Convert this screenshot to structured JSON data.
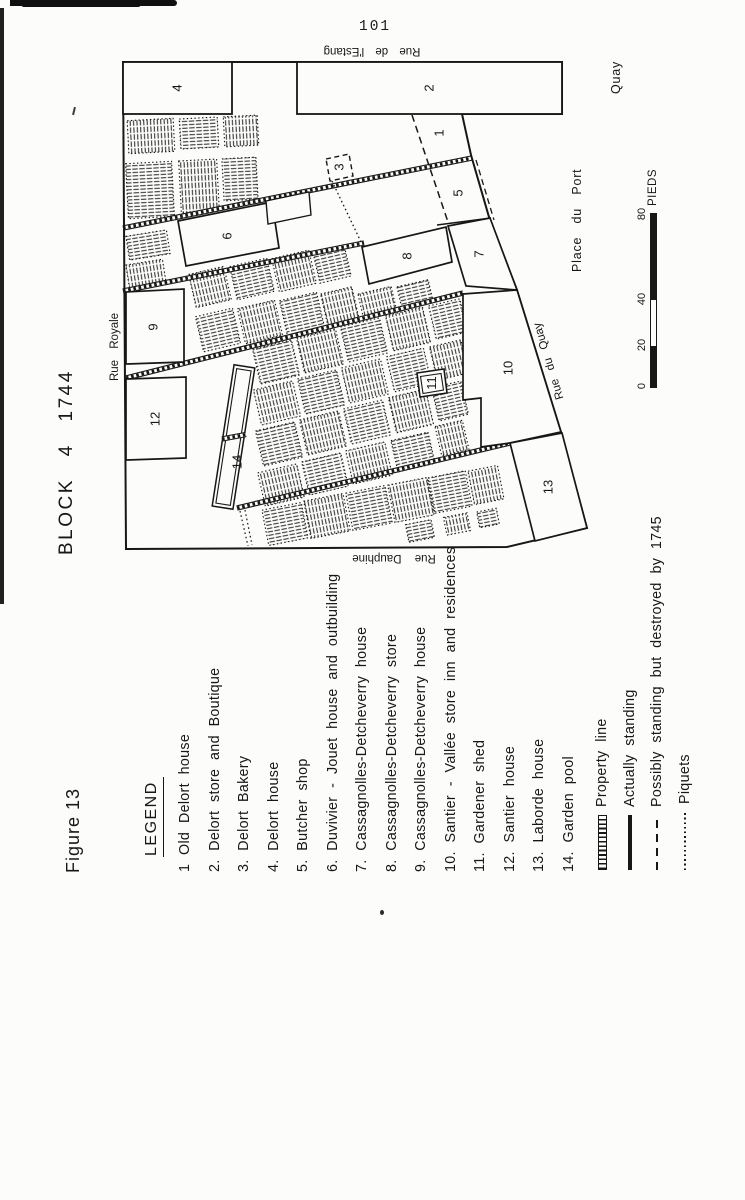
{
  "page_number": "101",
  "figure": {
    "label": "Figure 13",
    "title": "BLOCK 4 1744"
  },
  "map": {
    "streets": {
      "estang": "Rue de l'Estang",
      "royale": "Rue Royale",
      "dauphine": "Rue Dauphine",
      "du_quay": "Rue du Quay",
      "place_du_port": "Place du Port",
      "quay": "Quay"
    },
    "lots": {
      "n1": "1",
      "n2": "2",
      "n3": "3",
      "n4": "4",
      "n5": "5",
      "n6": "6",
      "n7": "7",
      "n8": "8",
      "n9": "9",
      "n10": "10",
      "n11": "11",
      "n12": "12",
      "n13": "13",
      "n14": "14"
    }
  },
  "scale_bar": {
    "ticks": [
      "0",
      "20",
      "40",
      "80"
    ],
    "unit": "PIEDS"
  },
  "legend": {
    "heading": "LEGEND",
    "items": [
      "1 Old Delort house",
      "2. Delort store and Boutique",
      "3. Delort Bakery",
      "4. Delort house",
      "5. Butcher shop",
      "6. Duvivier - Jouet house and outbuilding",
      "7. Cassagnolles-Detcheverry house",
      "8. Cassagnolles-Detcheverry store",
      "9. Cassagnolles-Detcheverry house",
      "10. Santier - Vallée store inn and residences",
      "11. Gardener shed",
      "12. Santier house",
      "13. Laborde house",
      "14. Garden pool"
    ],
    "symbols": [
      {
        "label": "Property line",
        "kind": "property-line"
      },
      {
        "label": "Actually standing",
        "kind": "actually-standing"
      },
      {
        "label": "Possibly standing but destroyed by 1745",
        "kind": "possibly-standing"
      },
      {
        "label": "Piquets",
        "kind": "piquets"
      }
    ]
  }
}
